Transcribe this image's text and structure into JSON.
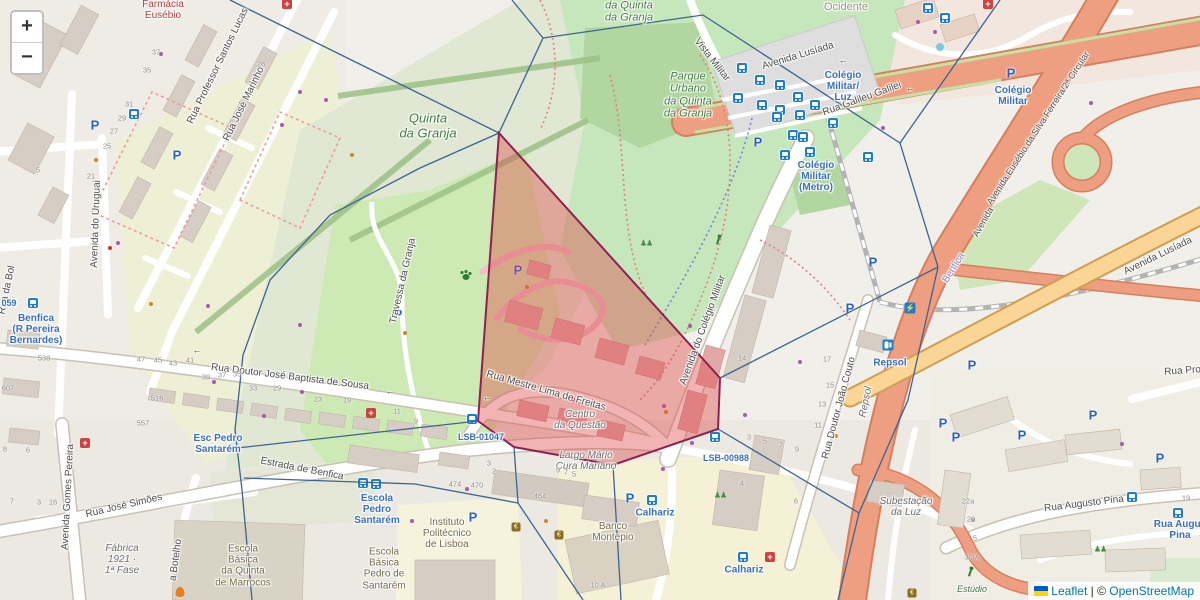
{
  "controls": {
    "zoom_in": "+",
    "zoom_out": "−"
  },
  "attribution": {
    "leaflet": "Leaflet",
    "sep": " | ",
    "copyright": "© ",
    "osm": "OpenStreetMap"
  },
  "overlay": {
    "edge_color": "#3c6493",
    "cell_stroke": "#8d2150",
    "cell_fill": "rgba(221,75,75,0.42)",
    "red_polygon": [
      [
        499,
        133
      ],
      [
        720,
        378
      ],
      [
        718,
        429
      ],
      [
        613,
        465
      ],
      [
        514,
        447
      ],
      [
        478,
        421
      ]
    ],
    "edges": [
      [
        [
          230,
          0
        ],
        [
          499,
          133
        ]
      ],
      [
        [
          512,
          0
        ],
        [
          543,
          38
        ]
      ],
      [
        [
          543,
          38
        ],
        [
          499,
          133
        ]
      ],
      [
        [
          543,
          38
        ],
        [
          703,
          15
        ],
        [
          900,
          143
        ],
        [
          938,
          267
        ]
      ],
      [
        [
          900,
          143
        ],
        [
          1000,
          0
        ]
      ],
      [
        [
          938,
          267
        ],
        [
          720,
          378
        ]
      ],
      [
        [
          938,
          267
        ],
        [
          908,
          400
        ],
        [
          859,
          513
        ]
      ],
      [
        [
          859,
          513
        ],
        [
          838,
          600
        ]
      ],
      [
        [
          718,
          429
        ],
        [
          859,
          513
        ]
      ],
      [
        [
          499,
          133
        ],
        [
          420,
          168
        ],
        [
          330,
          215
        ],
        [
          270,
          280
        ],
        [
          243,
          355
        ],
        [
          235,
          430
        ],
        [
          242,
          490
        ],
        [
          252,
          600
        ]
      ],
      [
        [
          237,
          448
        ],
        [
          478,
          421
        ]
      ],
      [
        [
          244,
          478
        ],
        [
          415,
          484
        ],
        [
          518,
          503
        ]
      ],
      [
        [
          514,
          447
        ],
        [
          518,
          503
        ]
      ],
      [
        [
          518,
          503
        ],
        [
          583,
          600
        ]
      ],
      [
        [
          613,
          465
        ],
        [
          621,
          600
        ]
      ]
    ]
  },
  "labels": [
    {
      "t": "Rua Professor Santos Lucas",
      "x": 218,
      "y": 66,
      "r": -64,
      "c": "st"
    },
    {
      "t": "Rua José Marinho",
      "x": 244,
      "y": 104,
      "r": -64,
      "c": "st"
    },
    {
      "t": "Avenida do Uruguai",
      "x": 96,
      "y": 224,
      "r": -88,
      "c": "st"
    },
    {
      "t": "Rua da Bol",
      "x": 7,
      "y": 290,
      "r": -78,
      "c": "st"
    },
    {
      "t": "Vista Militar",
      "x": 712,
      "y": 60,
      "r": 52,
      "c": "st"
    },
    {
      "t": "Avenida Lusíada",
      "x": 798,
      "y": 56,
      "r": -17,
      "c": "st"
    },
    {
      "t": "Rua Galileu Galilei",
      "x": 862,
      "y": 99,
      "r": -20,
      "c": "st"
    },
    {
      "t": "Avenida Eusébio da Silva Ferreira/2ª Circular",
      "x": 1038,
      "y": 128,
      "r": -57,
      "c": "st",
      "s": 9
    },
    {
      "t": "Avenida Lusíada",
      "x": 1158,
      "y": 256,
      "r": -26,
      "c": "st"
    },
    {
      "t": "Avenida",
      "x": 983,
      "y": 222,
      "r": -60,
      "c": "st",
      "s": 9
    },
    {
      "t": "Rua Doutor José Baptista de Sousa",
      "x": 290,
      "y": 377,
      "r": 7,
      "c": "st"
    },
    {
      "t": "Estrada de Benfica",
      "x": 302,
      "y": 469,
      "r": 11,
      "c": "st"
    },
    {
      "t": "Rua José Simões",
      "x": 124,
      "y": 506,
      "r": -13,
      "c": "st"
    },
    {
      "t": "Avenida Gomes Pereira",
      "x": 68,
      "y": 497,
      "r": -87,
      "c": "st"
    },
    {
      "t": "a Botelho",
      "x": 176,
      "y": 560,
      "r": -82,
      "c": "st"
    },
    {
      "t": "Travessa da Granja",
      "x": 403,
      "y": 281,
      "r": -77,
      "c": "st"
    },
    {
      "t": "Rua Mestre Lima de Freitas",
      "x": 546,
      "y": 391,
      "r": 16,
      "c": "st"
    },
    {
      "t": "Avenida do Colégio Militar",
      "x": 703,
      "y": 330,
      "r": -70,
      "c": "st"
    },
    {
      "t": "Rua Doutor João Couto",
      "x": 839,
      "y": 408,
      "r": -75,
      "c": "st"
    },
    {
      "t": "Rua Augusto Pina",
      "x": 1084,
      "y": 504,
      "r": -7,
      "c": "st"
    },
    {
      "t": "Rua Prof",
      "x": 1184,
      "y": 371,
      "r": -4,
      "c": "st"
    },
    {
      "t": "Quinta\nda Granja",
      "x": 428,
      "y": 126,
      "c": "pg",
      "s": 13
    },
    {
      "t": "Parque\nUrbano\nda Quinta\nda Granja",
      "x": 688,
      "y": 95,
      "c": "pg",
      "s": 11
    },
    {
      "t": "da Quinta\nda Granja",
      "x": 629,
      "y": 12,
      "c": "pg",
      "s": 11
    },
    {
      "t": "Estúdio",
      "x": 972,
      "y": 589,
      "c": "pg",
      "s": 9
    },
    {
      "t": "Ocidente",
      "x": 846,
      "y": 7,
      "c": "pgr"
    },
    {
      "t": "Colégio\nMilitar/\nLuz",
      "x": 843,
      "y": 87,
      "c": "tb"
    },
    {
      "t": "Colégio\nMilitar",
      "x": 1013,
      "y": 96,
      "c": "tb"
    },
    {
      "t": "Colégio\nMilitar\n(Metro)",
      "x": 816,
      "y": 177,
      "c": "tb"
    },
    {
      "t": "Benfica\n(R Pereira\nBernardes)",
      "x": 36,
      "y": 330,
      "c": "tb"
    },
    {
      "t": "059",
      "x": 9,
      "y": 303,
      "c": "tb",
      "s": 9
    },
    {
      "t": "Esc Pedro\nSantarém",
      "x": 218,
      "y": 444,
      "c": "tb"
    },
    {
      "t": "Escola\nPedro\nSantarém",
      "x": 377,
      "y": 510,
      "c": "tb"
    },
    {
      "t": "LSB-01047",
      "x": 481,
      "y": 437,
      "c": "tb",
      "s": 9
    },
    {
      "t": "LSB-00988",
      "x": 726,
      "y": 458,
      "c": "tb",
      "s": 9
    },
    {
      "t": "Calhariz",
      "x": 655,
      "y": 513,
      "c": "tb"
    },
    {
      "t": "Calhariz",
      "x": 744,
      "y": 570,
      "c": "tb"
    },
    {
      "t": "Repsol",
      "x": 890,
      "y": 363,
      "c": "tb"
    },
    {
      "t": "Rua Augus\nPina",
      "x": 1180,
      "y": 530,
      "c": "tb"
    },
    {
      "t": "Centro\nda Questão",
      "x": 580,
      "y": 420,
      "c": "pi"
    },
    {
      "t": "Largo Mário\nCura Mariano",
      "x": 586,
      "y": 461,
      "c": "pi"
    },
    {
      "t": "Fábrica\n1921 ·\n1ª Fase",
      "x": 122,
      "y": 560,
      "c": "pi"
    },
    {
      "t": "Subestação\nda Luz",
      "x": 906,
      "y": 507,
      "c": "pi"
    },
    {
      "t": "Repsol",
      "x": 866,
      "y": 402,
      "r": -78,
      "c": "pi"
    },
    {
      "t": "Escola\nBásica\nda Quinta\nde Marrocos",
      "x": 243,
      "y": 566,
      "c": "ps"
    },
    {
      "t": "Escola\nBásica\nPedro de\nSantarém",
      "x": 384,
      "y": 569,
      "c": "ps"
    },
    {
      "t": "Instituto\nPolitécnico\nde Lisboa",
      "x": 447,
      "y": 534,
      "c": "ps"
    },
    {
      "t": "Banco\nMontepio",
      "x": 613,
      "y": 532,
      "c": "ps"
    },
    {
      "t": "Benfica",
      "x": 954,
      "y": 268,
      "r": -58,
      "c": "rl"
    },
    {
      "t": "Farmácia\nEusébio",
      "x": 163,
      "y": 10,
      "c": "pr"
    },
    {
      "t": "←",
      "x": 197,
      "y": 350,
      "c": "ar"
    },
    {
      "t": "←",
      "x": 390,
      "y": 391,
      "c": "ar"
    },
    {
      "t": "←",
      "x": 487,
      "y": 397,
      "c": "ar"
    },
    {
      "t": "←",
      "x": 843,
      "y": 60,
      "c": "ar"
    },
    {
      "t": "←",
      "x": 910,
      "y": 88,
      "c": "ar"
    }
  ],
  "housenumbers": [
    [
      "37",
      156,
      52
    ],
    [
      "35",
      147,
      70
    ],
    [
      "31",
      129,
      104
    ],
    [
      "29",
      122,
      118
    ],
    [
      "27",
      114,
      131
    ],
    [
      "25",
      107,
      146
    ],
    [
      "21",
      91,
      176
    ],
    [
      "5",
      38,
      170
    ],
    [
      "28",
      261,
      64
    ],
    [
      "538",
      44,
      358
    ],
    [
      "607",
      8,
      388
    ],
    [
      "47",
      141,
      359
    ],
    [
      "45",
      158,
      360
    ],
    [
      "43",
      173,
      363
    ],
    [
      "41",
      190,
      360
    ],
    [
      "39",
      206,
      377
    ],
    [
      "37",
      222,
      375
    ],
    [
      "35",
      237,
      374
    ],
    [
      "33",
      253,
      388
    ],
    [
      "29",
      277,
      388
    ],
    [
      "23",
      318,
      399
    ],
    [
      "19",
      347,
      400
    ],
    [
      "11",
      397,
      411
    ],
    [
      "9",
      416,
      421
    ],
    [
      "516",
      157,
      398
    ],
    [
      "557",
      143,
      423
    ],
    [
      "474",
      455,
      484
    ],
    [
      "470",
      477,
      485
    ],
    [
      "464",
      540,
      496
    ],
    [
      "8",
      5,
      449
    ],
    [
      "6",
      28,
      450
    ],
    [
      "7",
      12,
      501
    ],
    [
      "3",
      39,
      502
    ],
    [
      "16",
      53,
      502
    ],
    [
      "14",
      742,
      358
    ],
    [
      "17",
      827,
      359
    ],
    [
      "15",
      830,
      385
    ],
    [
      "13",
      822,
      404
    ],
    [
      "11",
      818,
      425
    ],
    [
      "3",
      749,
      437
    ],
    [
      "5",
      765,
      441
    ],
    [
      "7",
      781,
      445
    ],
    [
      "9",
      797,
      449
    ],
    [
      "4",
      742,
      483
    ],
    [
      "6",
      796,
      501
    ],
    [
      "22a",
      968,
      501
    ],
    [
      "20",
      971,
      519
    ],
    [
      "5",
      975,
      538
    ],
    [
      "3/3A",
      972,
      557
    ],
    [
      "19",
      1186,
      498
    ],
    [
      "10 A",
      598,
      585
    ],
    [
      "3",
      489,
      463
    ],
    [
      "2",
      494,
      471
    ],
    [
      "9",
      558,
      470
    ],
    [
      "7",
      566,
      472
    ],
    [
      "5",
      574,
      474
    ]
  ],
  "icons": [
    [
      "bus",
      33,
      303
    ],
    [
      "bus",
      134,
      114
    ],
    [
      "bus",
      472,
      419
    ],
    [
      "bus",
      715,
      437
    ],
    [
      "bus",
      652,
      500
    ],
    [
      "bus",
      743,
      557
    ],
    [
      "bus",
      363,
      483
    ],
    [
      "bus",
      376,
      484
    ],
    [
      "bus",
      1132,
      497
    ],
    [
      "bus",
      1178,
      513
    ],
    [
      "bus",
      945,
      18
    ],
    [
      "bus",
      928,
      8
    ],
    [
      "bus",
      742,
      68
    ],
    [
      "bus",
      760,
      80
    ],
    [
      "bus",
      780,
      85
    ],
    [
      "bus",
      798,
      97
    ],
    [
      "bus",
      815,
      105
    ],
    [
      "bus",
      738,
      98
    ],
    [
      "bus",
      762,
      105
    ],
    [
      "bus",
      780,
      110
    ],
    [
      "bus",
      800,
      115
    ],
    [
      "bus",
      777,
      117
    ],
    [
      "bus",
      833,
      123
    ],
    [
      "bus",
      793,
      135
    ],
    [
      "bus",
      803,
      137
    ],
    [
      "bus",
      810,
      152
    ],
    [
      "bus",
      785,
      155
    ],
    [
      "bus",
      868,
      157
    ],
    [
      "p",
      95,
      125
    ],
    [
      "p",
      177,
      155
    ],
    [
      "p",
      398,
      314
    ],
    [
      "p",
      518,
      270
    ],
    [
      "p",
      758,
      142
    ],
    [
      "p",
      1011,
      73
    ],
    [
      "p",
      873,
      262
    ],
    [
      "p",
      850,
      308
    ],
    [
      "p",
      473,
      517
    ],
    [
      "p",
      630,
      498
    ],
    [
      "p",
      972,
      365
    ],
    [
      "p",
      943,
      423
    ],
    [
      "p",
      956,
      437
    ],
    [
      "p",
      1022,
      435
    ],
    [
      "p",
      1093,
      415
    ],
    [
      "p",
      1160,
      458
    ],
    [
      "med",
      287,
      4
    ],
    [
      "med",
      85,
      443
    ],
    [
      "med",
      371,
      413
    ],
    [
      "med",
      770,
      557
    ],
    [
      "med",
      988,
      4
    ],
    [
      "fuel",
      888,
      345
    ],
    [
      "charge",
      910,
      308
    ],
    [
      "bank",
      516,
      527
    ],
    [
      "bank",
      559,
      535
    ],
    [
      "bank",
      912,
      593
    ],
    [
      "paw",
      466,
      277
    ],
    [
      "play",
      646,
      243
    ],
    [
      "play",
      1100,
      549
    ],
    [
      "play",
      720,
      495
    ],
    [
      "run",
      718,
      241
    ],
    [
      "run",
      970,
      573
    ],
    [
      "flame",
      180,
      592
    ],
    [
      "fountain",
      940,
      47
    ]
  ],
  "dots": {
    "purple": [
      [
        300,
        92
      ],
      [
        326,
        100
      ],
      [
        282,
        125
      ],
      [
        161,
        54
      ],
      [
        118,
        243
      ],
      [
        208,
        306
      ],
      [
        300,
        325
      ],
      [
        214,
        382
      ],
      [
        264,
        416
      ],
      [
        302,
        392
      ],
      [
        467,
        489
      ],
      [
        412,
        521
      ],
      [
        573,
        399
      ],
      [
        664,
        406
      ],
      [
        692,
        443
      ],
      [
        745,
        415
      ],
      [
        800,
        362
      ],
      [
        883,
        128
      ],
      [
        918,
        22
      ],
      [
        935,
        32
      ],
      [
        1091,
        103
      ],
      [
        1122,
        444
      ],
      [
        973,
        520
      ],
      [
        663,
        469
      ],
      [
        690,
        326
      ]
    ],
    "orange": [
      [
        96,
        160
      ],
      [
        151,
        304
      ],
      [
        405,
        333
      ],
      [
        546,
        521
      ],
      [
        666,
        412
      ],
      [
        836,
        436
      ],
      [
        352,
        155
      ],
      [
        527,
        287
      ]
    ],
    "red": [
      [
        110,
        248
      ],
      [
        599,
        455
      ]
    ]
  }
}
